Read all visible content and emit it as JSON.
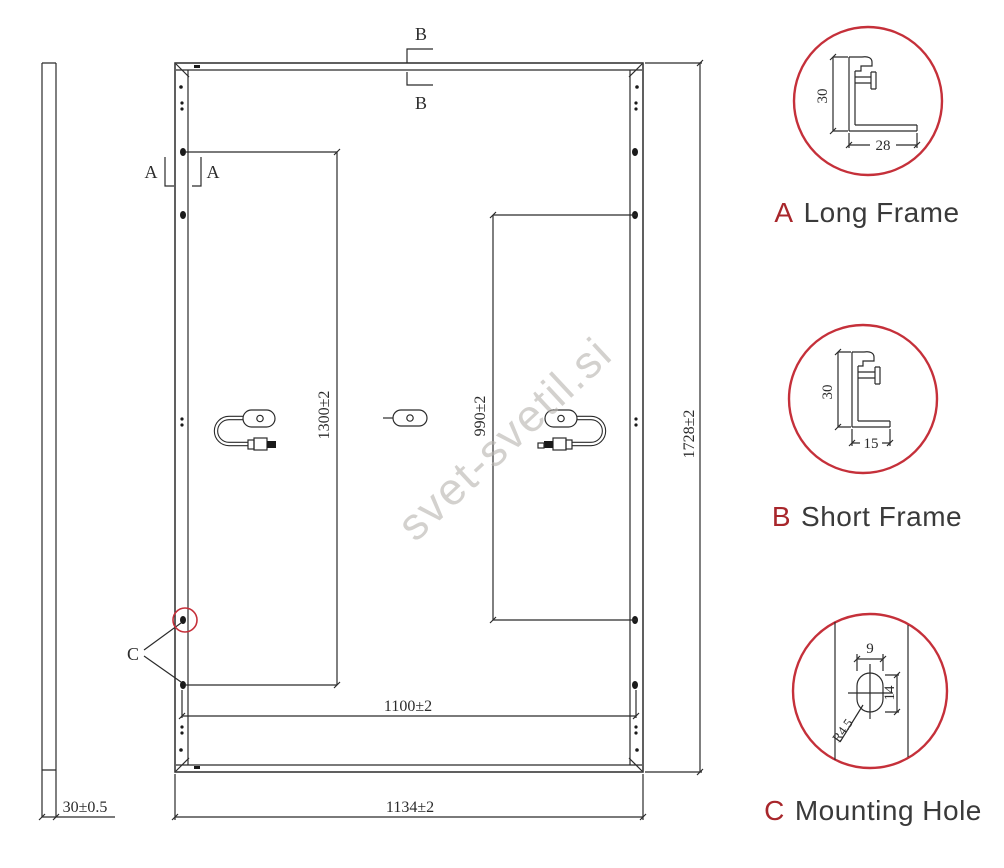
{
  "watermark": {
    "text": "svet-svetil.si"
  },
  "colors": {
    "accent_red": "#c5303a",
    "letter_red": "#a8262b",
    "line": "#2b2b2b"
  },
  "main_drawing": {
    "section_markers": {
      "a": "A",
      "b": "B",
      "c": "C"
    },
    "dimensions": {
      "overall_height": "1728±2",
      "overall_width": "1134±2",
      "mounting_hole_span_width": "1100±2",
      "mounting_hole_span_long": "1300±2",
      "mounting_hole_span_short": "990±2",
      "frame_thickness": "30±0.5"
    }
  },
  "details": {
    "a": {
      "letter": "A",
      "title": "Long Frame",
      "dim_height": "30",
      "dim_width": "28"
    },
    "b": {
      "letter": "B",
      "title": "Short Frame",
      "dim_height": "30",
      "dim_width": "15"
    },
    "c": {
      "letter": "C",
      "title": "Mounting Hole",
      "dim_width": "9",
      "dim_height": "14",
      "dim_radius": "R4.5"
    }
  }
}
